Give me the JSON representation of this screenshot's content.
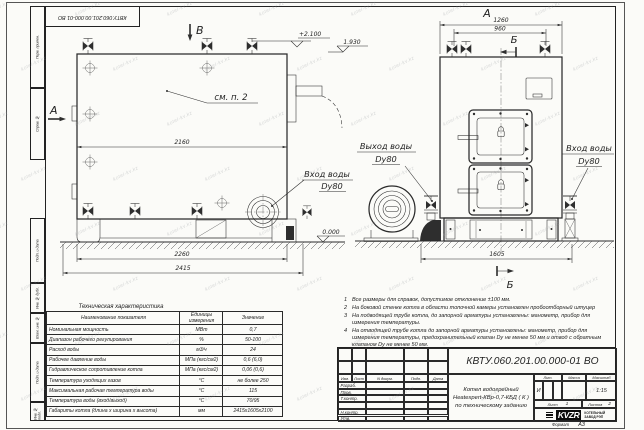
{
  "watermark": {
    "text": "kotel-kv.kz"
  },
  "frame": {
    "top_stamp": "КВТУ.060.201.00.000-01 ВО",
    "side_labels": {
      "perv_primen": "Перв. примен.",
      "sprav_no": "Справ. №",
      "podp_data_1": "Подп. и дата",
      "inv_dubl": "Инв. № дубл.",
      "vzam_inv": "Взам. инв. №",
      "podp_data_2": "Подп. и дата",
      "inv_podl": "Инв. № подл."
    },
    "format_label": "Формат",
    "format_value": "А3"
  },
  "drawing": {
    "side_view": {
      "section_mark_top": "В",
      "section_mark_left": "А",
      "callout": "см. п. 2",
      "elevation_top": "+2.100",
      "elevation_fan": "1.930",
      "elevation_ground": "0.000",
      "dim_body_width": "2160",
      "dim_base_width": "2260",
      "dim_overall_width": "2415",
      "inlet_line1": "Вход воды",
      "inlet_line2": "Dy80"
    },
    "front_view": {
      "view_mark": "А",
      "section_mark_top": "Б",
      "section_mark_bottom": "Б",
      "dim_top": "1260",
      "dim_valves": "960",
      "dim_base": "1605",
      "outlet_line1": "Выход воды",
      "outlet_line2": "Dy80",
      "inlet_line1": "Вход воды",
      "inlet_line2": "Dy80"
    }
  },
  "spec_table": {
    "title": "Техническая характеристика",
    "headers": [
      "Наименование показателя",
      "Единицы измерения",
      "Значение"
    ],
    "rows": [
      [
        "Номинальная мощность",
        "МВт",
        "0,7"
      ],
      [
        "Диапазон рабочего регулирования",
        "%",
        "50-100"
      ],
      [
        "Расход воды",
        "м3/ч",
        "24"
      ],
      [
        "Рабочее давление воды",
        "МПа (кгс/см2)",
        "0,6 (6,0)"
      ],
      [
        "Гидравлическое сопротивление котла",
        "МПа (кгс/см2)",
        "0,06 (0,6)"
      ],
      [
        "Температура уходящих газов",
        "°С",
        "не более 250"
      ],
      [
        "Максимальная рабочая температура воды",
        "°С",
        "115"
      ],
      [
        "Температура воды (вход/выход)",
        "°С",
        "70/95"
      ],
      [
        "Габариты котла (длина х ширина х высота)",
        "мм",
        "2415х1605х2100"
      ]
    ]
  },
  "notes": [
    {
      "num": "1",
      "text": "Все размеры для справок, допустимое отклонение ±100 мм."
    },
    {
      "num": "2",
      "text": "На боковой стенке котла в области топочной камеры установлен пробоотборный штуцер"
    },
    {
      "num": "3",
      "text": "На  подводящей трубе котла, до запорной арматуры установлены: манометр, прибор для измерения температуры."
    },
    {
      "num": "4",
      "text": "На отводящей трубе котла до запорной арматуры установлены: манометр, прибор для измерения температуры, предохранительный клапан Dy не менее 50 мм и отвод с обратным клапаном Dy не менее 50 мм."
    }
  ],
  "title_block": {
    "doc_number": "КВТУ.060.201.00.000-01 ВО",
    "product_line1": "Котел водогрейный",
    "product_line2": "Heatexpert-КВр-0,7-КБД ( К )",
    "product_line3": "по техническому заданию",
    "col_izm": "Изм.",
    "col_list": "Лист",
    "col_docnum": "N докум.",
    "col_podp": "Подп.",
    "col_data": "Дата",
    "row_razrab": "Разраб.",
    "row_prov": "Пров.",
    "row_tkontr": "Т.контр.",
    "row_nkontr": "Н.контр.",
    "row_utv": "Утв.",
    "lit_label": "Лит.",
    "lit_value": "И",
    "mass_label": "Масса",
    "scale_label": "Масштаб",
    "scale_value": "1:15",
    "sheet_label": "Лист",
    "sheet_value": "1",
    "sheets_label": "Листов",
    "sheets_value": "2",
    "logo": "KVZR",
    "company_line1": "КОТЕЛЬНЫЙ",
    "company_line2": "ЗАВОД РЭП"
  }
}
